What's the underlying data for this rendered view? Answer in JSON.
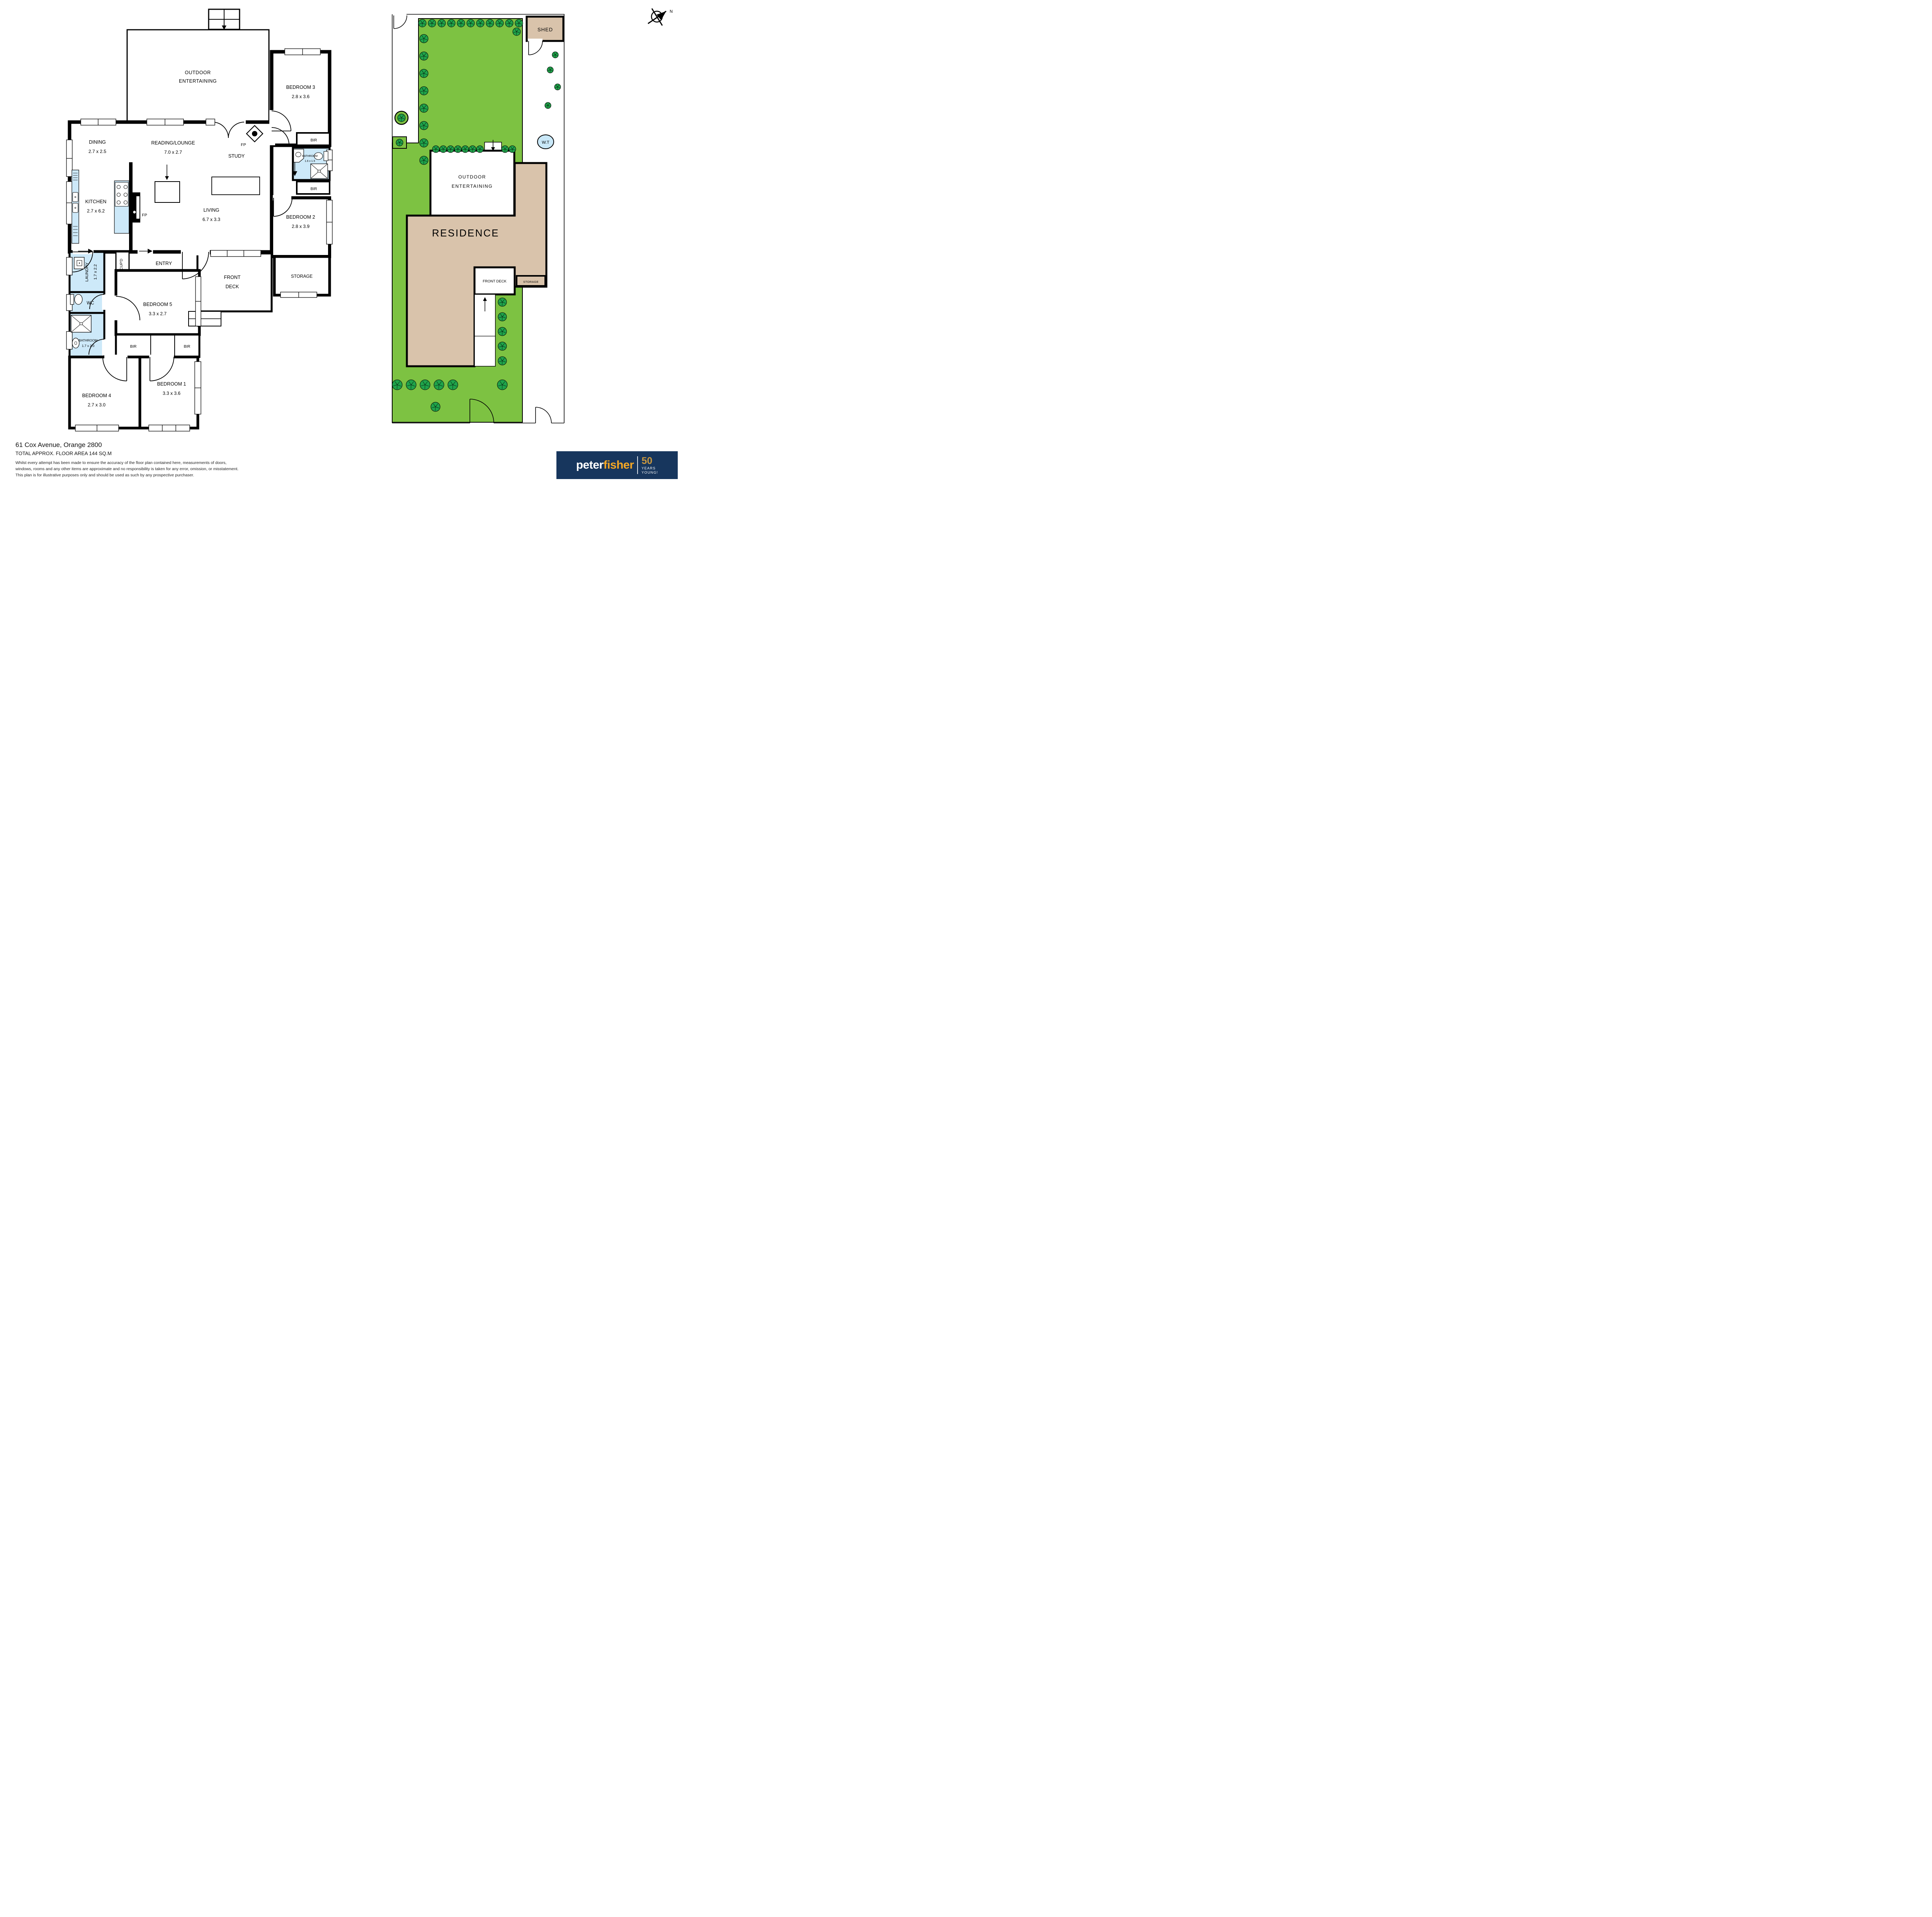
{
  "floor_plan": {
    "rooms": {
      "outdoor_entertaining": {
        "name_line1": "OUTDOOR",
        "name_line2": "ENTERTAINING"
      },
      "bedroom3": {
        "name": "BEDROOM 3",
        "dims": "2.8 x 3.6"
      },
      "bir": "BIR",
      "fireplace": "FP",
      "bathroom_hall": {
        "name": "BATHROOM",
        "dims": "1.6 x 1.5"
      },
      "bedroom2": {
        "name": "BEDROOM 2",
        "dims": "2.8 x 3.9"
      },
      "dining": {
        "name": "DINING",
        "dims": "2.7 x 2.5"
      },
      "reading_lounge": {
        "name": "READING/LOUNGE",
        "dims": "7.0 x 2.7"
      },
      "study": {
        "name": "STUDY"
      },
      "kitchen": {
        "name": "KITCHEN",
        "dims": "2.7 x 6.2"
      },
      "living": {
        "name": "LIVING",
        "dims": "6.7 x 3.3"
      },
      "laundry": {
        "name": "LAUNDRY",
        "dims": "1.7 x 2.2"
      },
      "wc": {
        "name": "WC"
      },
      "bathroom_main": {
        "name": "BATHROOM",
        "dims": "1.7 x 2.0"
      },
      "cupboard": {
        "name": "CUP'D"
      },
      "entry": {
        "name": "ENTRY"
      },
      "front_deck": {
        "name_line1": "FRONT",
        "name_line2": "DECK"
      },
      "storage": {
        "name": "STORAGE"
      },
      "bedroom5": {
        "name": "BEDROOM 5",
        "dims": "3.3 x 2.7"
      },
      "bedroom4": {
        "name": "BEDROOM 4",
        "dims": "2.7 x 3.0"
      },
      "bedroom1": {
        "name": "BEDROOM 1",
        "dims": "3.3 x 3.6"
      }
    }
  },
  "site_plan": {
    "shed": "SHED",
    "water_tank": "W.T",
    "outdoor_line1": "OUTDOOR",
    "outdoor_line2": "ENTERTAINING",
    "residence": "RESIDENCE",
    "front_deck": "FRONT DECK",
    "storage": "STORAGE",
    "compass_north": "N"
  },
  "footer": {
    "address": "61 Cox Avenue, Orange 2800",
    "area": "TOTAL APPROX. FLOOR AREA 144 SQ.M",
    "disclaimer_line1": "Whilst every attempt has been made to ensure the accuracy of the floor plan contained here, measurements of doors,",
    "disclaimer_line2": "windows, rooms and any other items are approximate and no responsibility is taken for any error, omission, or misstatement.",
    "disclaimer_line3": "This plan is for illustrative purposes only and should be used as such by any prospective purchaser."
  },
  "logo": {
    "brand_first": "peter",
    "brand_second": "fisher",
    "badge_number": "50",
    "badge_line1": "YEARS",
    "badge_line2": "YOUNG!"
  },
  "colors": {
    "lawn_green": "#7DC242",
    "tree_green": "#1FA34A",
    "residence_tan": "#D9C3AB",
    "wet_area_blue": "#CDE9F9",
    "logo_navy": "#17365D",
    "logo_orange": "#F7A823",
    "logo_gold": "#C9983F"
  }
}
